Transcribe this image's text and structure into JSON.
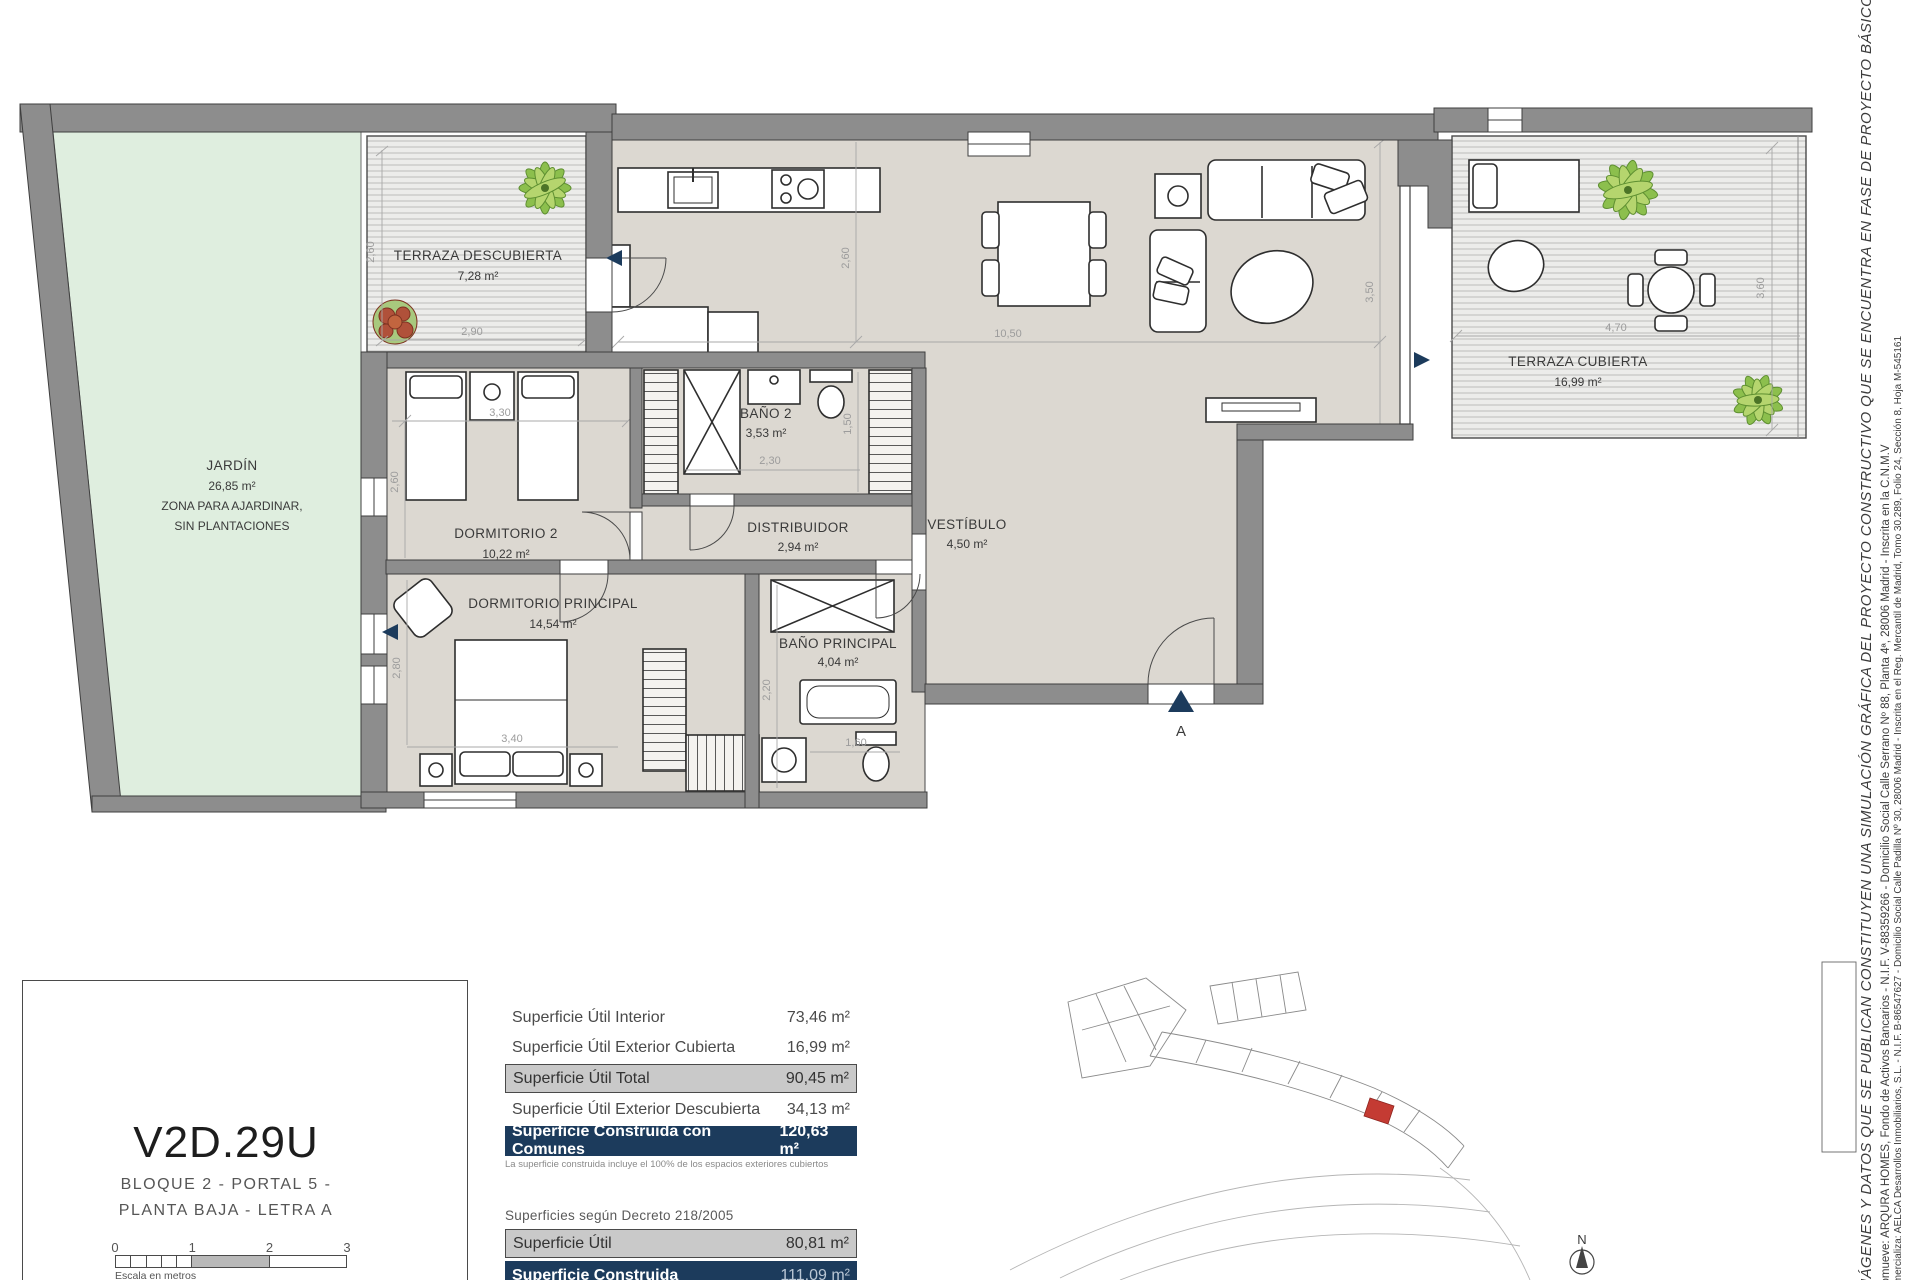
{
  "plan": {
    "rooms": [
      {
        "name": "TERRAZA DESCUBIERTA",
        "area": "7,28 m²"
      },
      {
        "name": "JARDÍN",
        "area": "26,85 m²",
        "note1": "ZONA PARA AJARDINAR,",
        "note2": "SIN PLANTACIONES"
      },
      {
        "name": "DORMITORIO 2",
        "area": "10,22 m²"
      },
      {
        "name": "BAÑO 2",
        "area": "3,53 m²"
      },
      {
        "name": "DISTRIBUIDOR",
        "area": "2,94 m²"
      },
      {
        "name": "VESTÍBULO",
        "area": "4,50 m²"
      },
      {
        "name": "DORMITORIO PRINCIPAL",
        "area": "14,54 m²"
      },
      {
        "name": "BAÑO PRINCIPAL",
        "area": "4,04 m²"
      },
      {
        "name": "TERRAZA CUBIERTA",
        "area": "16,99 m²"
      }
    ],
    "dims": {
      "td_h": "2,60",
      "td_w": "2,90",
      "kitchen_h": "2,60",
      "living_w": "10,50",
      "living_h": "3,50",
      "d2_w": "3,30",
      "d2_h": "2,60",
      "b2_w": "2,30",
      "b2_h": "1,50",
      "tc_w": "4,70",
      "tc_h": "3,60",
      "dp_w": "3,40",
      "dp_h": "2,80",
      "bp_h": "2,20",
      "bp_w": "1,60"
    },
    "entrance_marker": "A"
  },
  "unit": {
    "code": "V2D.29U",
    "line1": "BLOQUE 2 - PORTAL 5 -",
    "line2": "PLANTA BAJA - LETRA A",
    "scale": {
      "ticks": [
        "0",
        "1",
        "2",
        "3"
      ],
      "caption": "Escala en metros"
    }
  },
  "surfaces": {
    "rows": [
      {
        "label": "Superficie Útil Interior",
        "value": "73,46 m²"
      },
      {
        "label": "Superficie Útil Exterior Cubierta",
        "value": "16,99 m²"
      },
      {
        "label": "Superficie Útil Total",
        "value": "90,45 m²"
      },
      {
        "label": "Superficie Útil Exterior Descubierta",
        "value": "34,13 m²"
      },
      {
        "label": "Superficie Construida con Comunes",
        "value": "120,63 m²"
      }
    ],
    "footnote": "La superficie construida incluye el 100% de los espacios exteriores cubiertos",
    "decree_title": "Superficies según Decreto 218/2005",
    "decree_rows": [
      {
        "label": "Superficie Útil",
        "value": "80,81 m²"
      },
      {
        "label": "Superficie Construida",
        "value": "111,09 m²"
      }
    ]
  },
  "siteplan": {
    "north": "N"
  },
  "disclaimer": {
    "line1": "IMÁGENES Y DATOS QUE SE PUBLICAN CONSTITUYEN UNA SIMULACIÓN GRÁFICA DEL PROYECTO CONSTRUCTIVO QUE SE ENCUENTRA EN FASE DE PROYECTO BÁSICO",
    "line2": "Promueve: ARQURA HOMES, Fondo de Activos Bancarios - N.I.F. V-88359266 - Domicilio Social Calle Serrano Nº 88, Planta 4ª, 28006 Madrid - Inscrita en la C.N.M.V",
    "line3": "Comercializa: AELCA Desarrollos Inmobiliarios, S.L. - N.I.F. B-86547627 - Domicilio Social Calle Padilla Nº 30, 28006 Madrid - Inscrita en el Reg. Mercantil de Madrid, Tomo 30.289, Folio 24, Sección 8, Hoja M-545161"
  },
  "colors": {
    "wall": "#8d8d8d",
    "floor": "#dcd8d1",
    "garden": "#dfeedf",
    "navy": "#1c3b5c",
    "red_unit": "#c43b33"
  }
}
